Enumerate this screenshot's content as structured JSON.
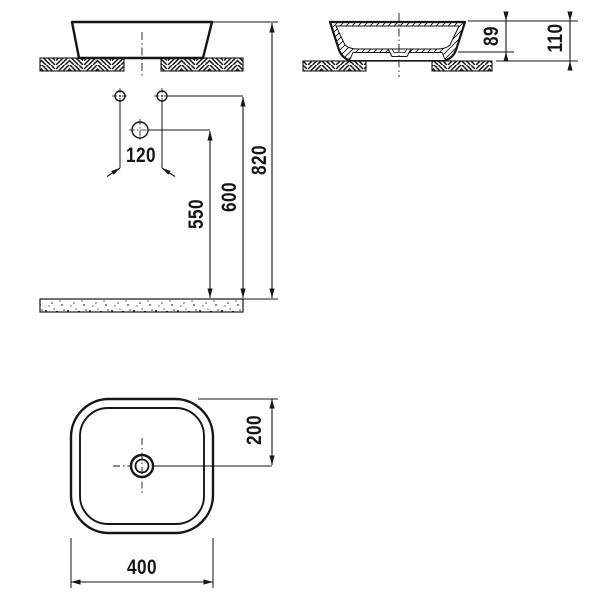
{
  "page": {
    "background": "#ffffff",
    "line_color": "#161616",
    "description": "technical-drawing-washbasin"
  },
  "dimensions": {
    "hole_spacing": "120",
    "height_mid": "550",
    "height_holes": "600",
    "height_total": "820",
    "basin_bowl_height": "89",
    "basin_total_height": "110",
    "center_offset": "200",
    "basin_width": "400"
  }
}
